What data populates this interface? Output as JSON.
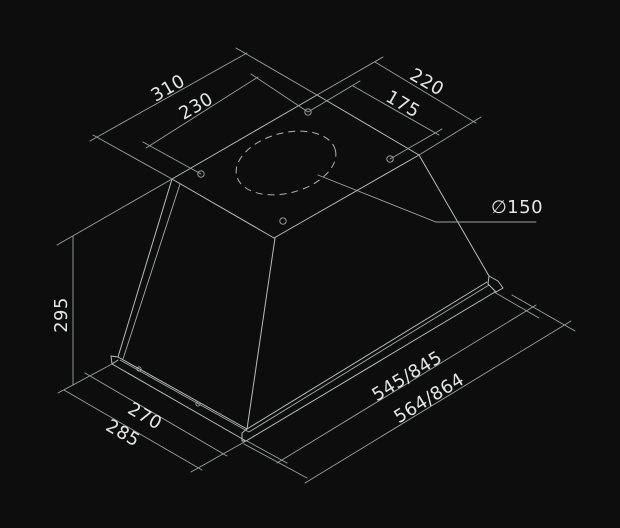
{
  "canvas": {
    "width": 620,
    "height": 528,
    "background": "#0d0d0d"
  },
  "colors": {
    "object_line": "#b8bcbd",
    "dimension_line": "#9aa0a1",
    "label_text": "#e4e6e6"
  },
  "drawing": {
    "subject": "built-in cooker hood isometric dimension drawing",
    "units": "mm",
    "labels": {
      "top_edge_length": "310",
      "top_holes_spacing": "230",
      "top_side_length": "220",
      "side_holes_spacing": "175",
      "exhaust_diameter": "∅150",
      "body_height": "295",
      "bottom_front_inner": "270",
      "bottom_front_outer": "285",
      "bottom_side_inner": "545/845",
      "bottom_side_outer": "564/864"
    }
  }
}
